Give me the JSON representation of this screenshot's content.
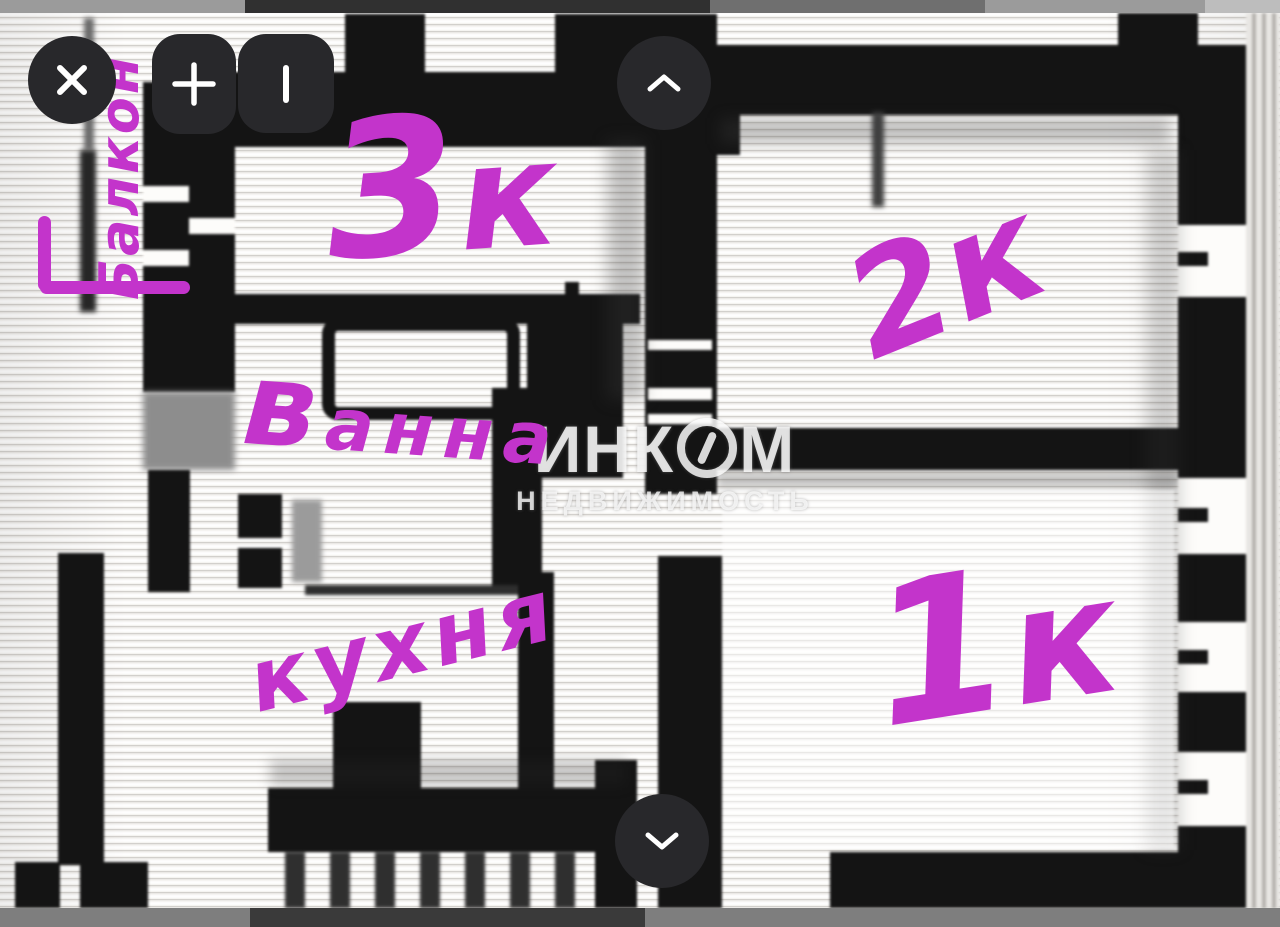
{
  "viewer": {
    "controls": [
      {
        "name": "close",
        "icon": "x-icon"
      },
      {
        "name": "zoom-in",
        "icon": "plus-icon"
      },
      {
        "name": "tool-bar",
        "icon": "vertical-bar-icon"
      },
      {
        "name": "scroll-up",
        "icon": "chevron-up-icon"
      },
      {
        "name": "scroll-down",
        "icon": "chevron-down-icon"
      }
    ]
  },
  "watermark": {
    "brand_left": "ИНК",
    "brand_right": "М",
    "logo": "digit-1-in-circle-icon",
    "subtitle": "НЕДВИЖИМОСТЬ"
  },
  "annotations": {
    "balcony": {
      "text": "Балкон"
    },
    "room3": {
      "text": "3к"
    },
    "room2": {
      "text": "2к"
    },
    "room1": {
      "text": "1к"
    },
    "bath": {
      "text": "ванна"
    },
    "kitchen": {
      "text": "кухня"
    }
  },
  "colors": {
    "annotation_ink": "#c334cb",
    "button_background": "#28282b",
    "button_glyph": "#ffffff"
  }
}
